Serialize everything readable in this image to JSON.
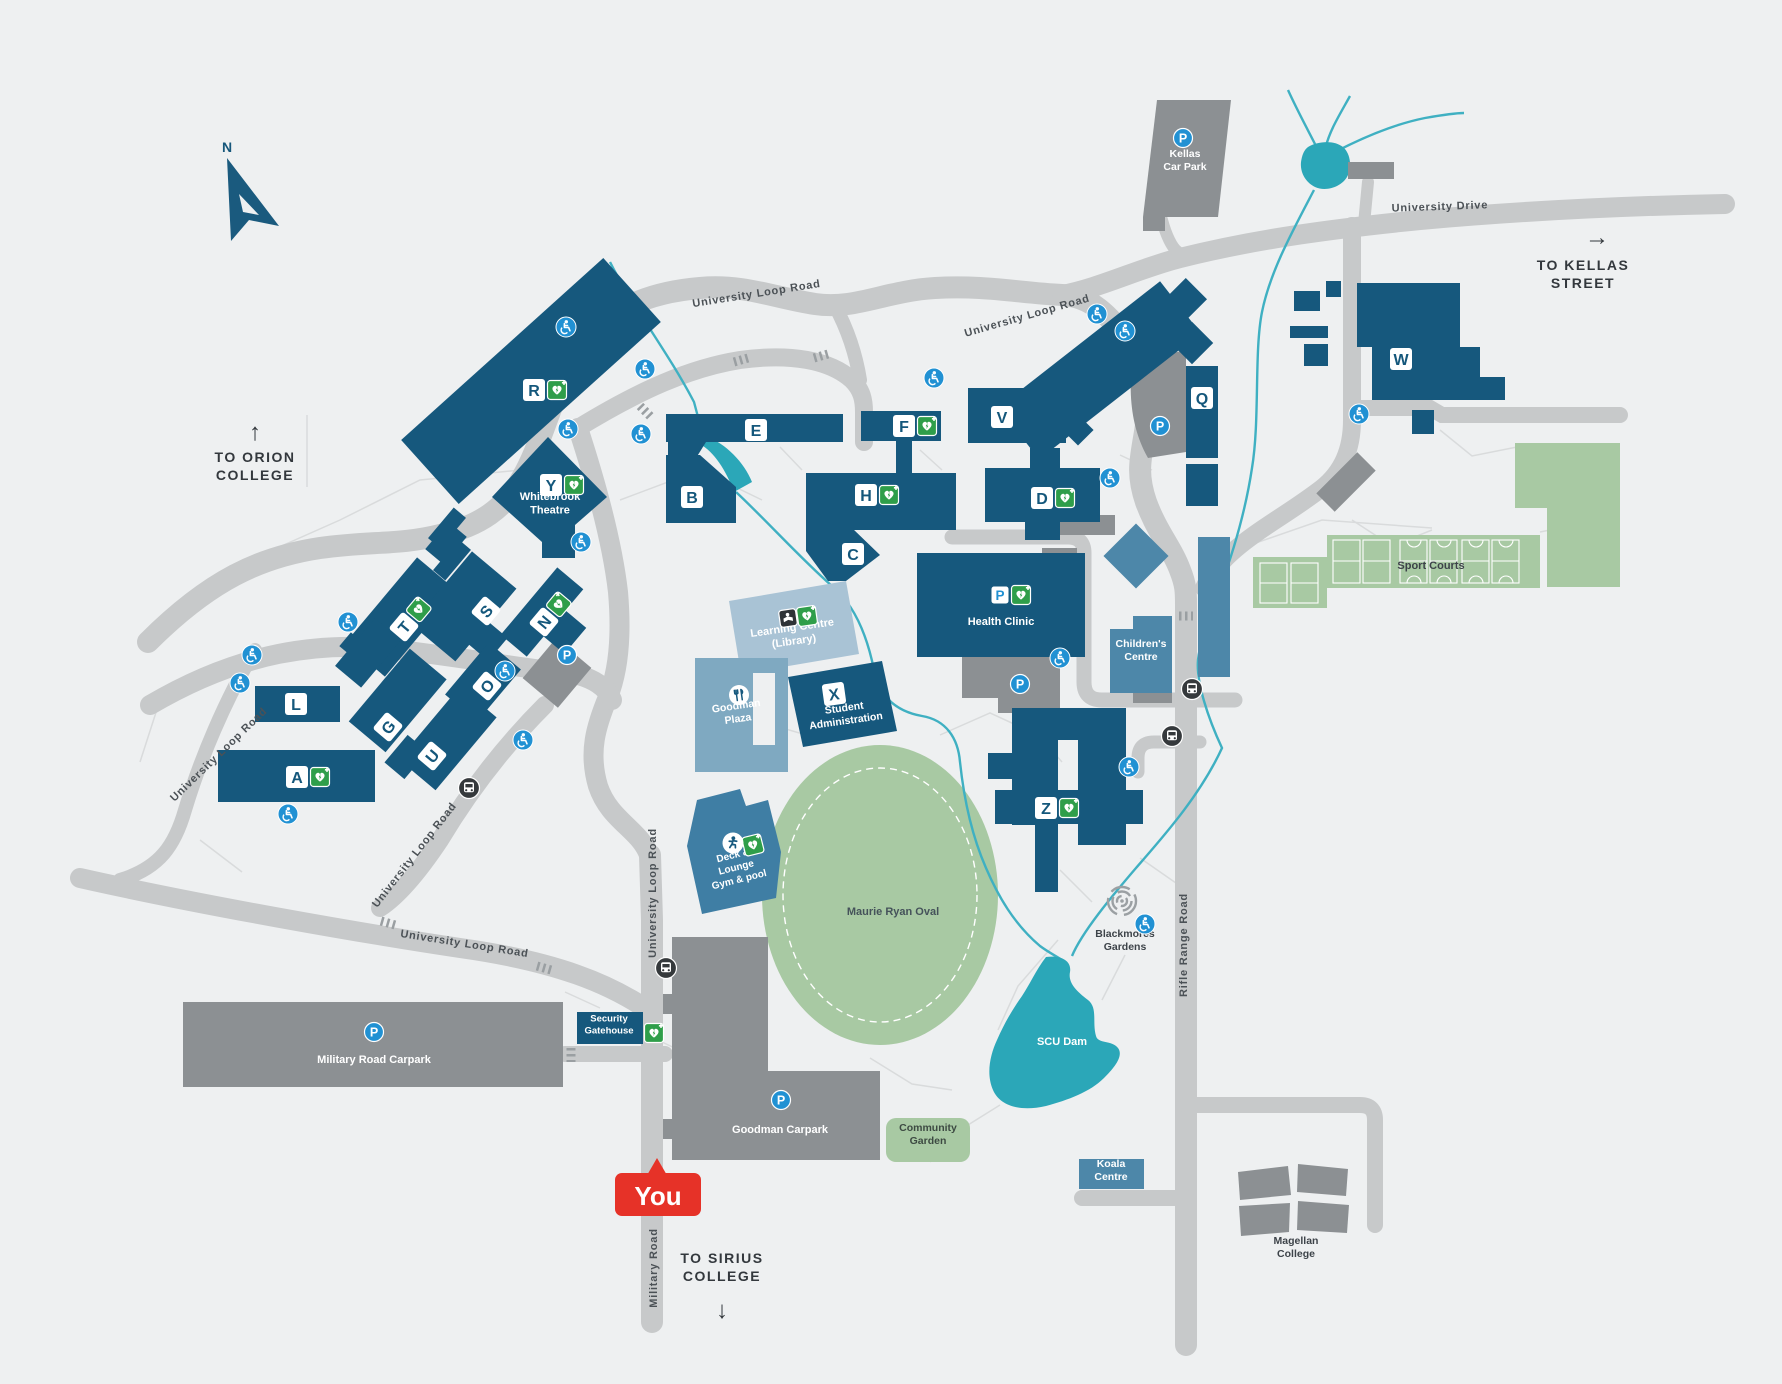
{
  "map": {
    "compass": {
      "label": "N"
    },
    "you": {
      "label": "You"
    },
    "directions": {
      "orion": {
        "arrow": "↑",
        "line1": "TO ORION",
        "line2": "COLLEGE"
      },
      "kellas": {
        "arrow": "→",
        "line1": "TO KELLAS",
        "line2": "STREET"
      },
      "sirius": {
        "arrow": "↓",
        "line1": "TO SIRIUS",
        "line2": "COLLEGE"
      }
    },
    "road_labels": [
      {
        "t": "University Drive",
        "x": 1440,
        "y": 210,
        "r": -2
      },
      {
        "t": "University Loop Road",
        "x": 757,
        "y": 297,
        "r": -9
      },
      {
        "t": "University Loop Road",
        "x": 1028,
        "y": 319,
        "r": -16
      },
      {
        "t": "University Loop Road",
        "x": 656,
        "y": 893,
        "r": -90
      },
      {
        "t": "University Loop Road",
        "x": 417,
        "y": 857,
        "r": -52
      },
      {
        "t": "University Loop Road",
        "x": 464,
        "y": 947,
        "r": 9
      },
      {
        "t": "University Loop Road",
        "x": 221,
        "y": 757,
        "r": -44
      },
      {
        "t": "Rifle Range Road",
        "x": 1187,
        "y": 945,
        "r": -90
      },
      {
        "t": "Military Road",
        "x": 657,
        "y": 1268,
        "r": -90
      }
    ],
    "building_badges": [
      {
        "l": "R",
        "x": 534,
        "y": 390,
        "defib": true
      },
      {
        "l": "Y",
        "x": 551,
        "y": 485,
        "defib": true
      },
      {
        "l": "E",
        "x": 756,
        "y": 430
      },
      {
        "l": "B",
        "x": 692,
        "y": 497
      },
      {
        "l": "F",
        "x": 904,
        "y": 426,
        "defib": true
      },
      {
        "l": "H",
        "x": 866,
        "y": 495,
        "defib": true
      },
      {
        "l": "C",
        "x": 853,
        "y": 554
      },
      {
        "l": "V",
        "x": 1002,
        "y": 417
      },
      {
        "l": "D",
        "x": 1042,
        "y": 498,
        "defib": true
      },
      {
        "l": "Q",
        "x": 1202,
        "y": 398
      },
      {
        "l": "W",
        "x": 1401,
        "y": 359
      },
      {
        "l": "T",
        "x": 404,
        "y": 627,
        "r": -50,
        "defib": true
      },
      {
        "l": "S",
        "x": 486,
        "y": 611,
        "r": -50
      },
      {
        "l": "N",
        "x": 544,
        "y": 622,
        "r": -50,
        "defib": true
      },
      {
        "l": "O",
        "x": 487,
        "y": 686,
        "r": -50
      },
      {
        "l": "G",
        "x": 388,
        "y": 727,
        "r": -50
      },
      {
        "l": "U",
        "x": 432,
        "y": 756,
        "r": -50
      },
      {
        "l": "L",
        "x": 296,
        "y": 704
      },
      {
        "l": "A",
        "x": 297,
        "y": 777,
        "defib": true
      },
      {
        "l": "X",
        "x": 834,
        "y": 694,
        "r": -8
      },
      {
        "l": "Z",
        "x": 1046,
        "y": 808,
        "defib": true
      }
    ],
    "places": [
      {
        "n": "whitebrook-theatre",
        "lines": [
          "Whitebrook",
          "Theatre"
        ],
        "x": 550,
        "y": 503,
        "c": "#ffffff",
        "s": 11
      },
      {
        "n": "learning-centre",
        "lines": [
          "Learning Centre",
          "(Library)"
        ],
        "x": 793,
        "y": 634,
        "c": "#ffffff",
        "s": 11,
        "r": -8
      },
      {
        "n": "goodman-plaza",
        "lines": [
          "Goodman",
          "Plaza"
        ],
        "x": 737,
        "y": 712,
        "c": "#ffffff",
        "s": 10.5,
        "r": -8
      },
      {
        "n": "student-administration",
        "lines": [
          "Student",
          "Administration"
        ],
        "x": 845,
        "y": 714,
        "c": "#ffffff",
        "s": 10.5,
        "r": -8
      },
      {
        "n": "health-clinic",
        "lines": [
          "Health Clinic"
        ],
        "x": 1001,
        "y": 621,
        "c": "#ffffff",
        "s": 11
      },
      {
        "n": "childrens-centre",
        "lines": [
          "Children's",
          "Centre"
        ],
        "x": 1141,
        "y": 650,
        "c": "#ffffff",
        "s": 10.5
      },
      {
        "n": "sport-courts",
        "lines": [
          "Sport Courts"
        ],
        "x": 1431,
        "y": 565,
        "c": "#3d4349",
        "s": 11
      },
      {
        "n": "maurie-ryan-oval",
        "lines": [
          "Maurie Ryan Oval"
        ],
        "x": 893,
        "y": 911,
        "c": "#45525a",
        "s": 11
      },
      {
        "n": "blackmores-gardens",
        "lines": [
          "Blackmores",
          "Gardens"
        ],
        "x": 1125,
        "y": 940,
        "c": "#3d4349",
        "s": 10.5
      },
      {
        "n": "scu-dam",
        "lines": [
          "SCU Dam"
        ],
        "x": 1062,
        "y": 1041,
        "c": "#ffffff",
        "s": 11
      },
      {
        "n": "community-garden",
        "lines": [
          "Community",
          "Garden"
        ],
        "x": 928,
        "y": 1134,
        "c": "#3d4a42",
        "s": 10.5
      },
      {
        "n": "koala-centre",
        "lines": [
          "Koala",
          "Centre"
        ],
        "x": 1111,
        "y": 1170,
        "c": "#ffffff",
        "s": 10.5
      },
      {
        "n": "magellan-college",
        "lines": [
          "Magellan",
          "College"
        ],
        "x": 1296,
        "y": 1247,
        "c": "#3d4349",
        "s": 10.5
      },
      {
        "n": "kellas-car-park",
        "lines": [
          "Kellas",
          "Car Park"
        ],
        "x": 1185,
        "y": 160,
        "c": "#ffffff",
        "s": 10.5
      },
      {
        "n": "military-road-carpark",
        "lines": [
          "Military Road Carpark"
        ],
        "x": 374,
        "y": 1059,
        "c": "#ffffff",
        "s": 11
      },
      {
        "n": "goodman-carpark",
        "lines": [
          "Goodman Carpark"
        ],
        "x": 780,
        "y": 1129,
        "c": "#ffffff",
        "s": 11
      },
      {
        "n": "security-gatehouse",
        "lines": [
          "Security",
          "Gatehouse"
        ],
        "x": 609,
        "y": 1024,
        "c": "#ffffff",
        "s": 9.5
      },
      {
        "n": "deck-lounge-gym-pool",
        "lines": [
          "Deck &",
          "Lounge",
          "Gym & pool"
        ],
        "x": 736,
        "y": 867,
        "c": "#ffffff",
        "s": 10,
        "r": -14
      }
    ],
    "icons": {
      "parking_letter": "P",
      "parking_circles": [
        [
          1183,
          138
        ],
        [
          374,
          1032
        ],
        [
          781,
          1100
        ],
        [
          1160,
          426
        ],
        [
          1020,
          684
        ],
        [
          567,
          655
        ]
      ],
      "parking_badges": [
        [
          1000,
          595
        ]
      ],
      "defibrillators": [
        [
          654,
          1033,
          0
        ],
        [
          1021,
          595,
          0
        ],
        [
          807,
          616,
          -8
        ],
        [
          753,
          845,
          -14
        ]
      ],
      "bus_stops": [
        [
          469,
          788
        ],
        [
          666,
          968
        ],
        [
          1192,
          689
        ],
        [
          1172,
          736
        ]
      ],
      "accessible": [
        [
          566,
          327
        ],
        [
          568,
          429
        ],
        [
          645,
          369
        ],
        [
          641,
          434
        ],
        [
          581,
          542
        ],
        [
          934,
          378
        ],
        [
          1097,
          314
        ],
        [
          1125,
          331
        ],
        [
          1110,
          478
        ],
        [
          1060,
          658
        ],
        [
          1359,
          414
        ],
        [
          1129,
          767
        ],
        [
          1145,
          924
        ],
        [
          252,
          655
        ],
        [
          240,
          683
        ],
        [
          348,
          622
        ],
        [
          505,
          671
        ],
        [
          523,
          740
        ],
        [
          288,
          814
        ]
      ],
      "gym_icon": [
        733,
        843
      ],
      "food_icon": [
        739,
        695
      ],
      "library_icon": [
        788,
        618
      ],
      "gardens_symbol": [
        1122,
        901
      ]
    },
    "colors": {
      "background": "#eef0f1",
      "building": "#16587d",
      "building_medium": "#4d87a9",
      "building_plaza": "#7fa9c1",
      "building_light": "#a9c3d5",
      "carpark_gray": "#8c9093",
      "road": "#c7c9ca",
      "green": "#a8c9a3",
      "water": "#2ba7b8",
      "you_red": "#e63228",
      "icon_blue": "#2191d3",
      "defib_green": "#2f9e4a",
      "bus_dark": "#35393c"
    }
  }
}
